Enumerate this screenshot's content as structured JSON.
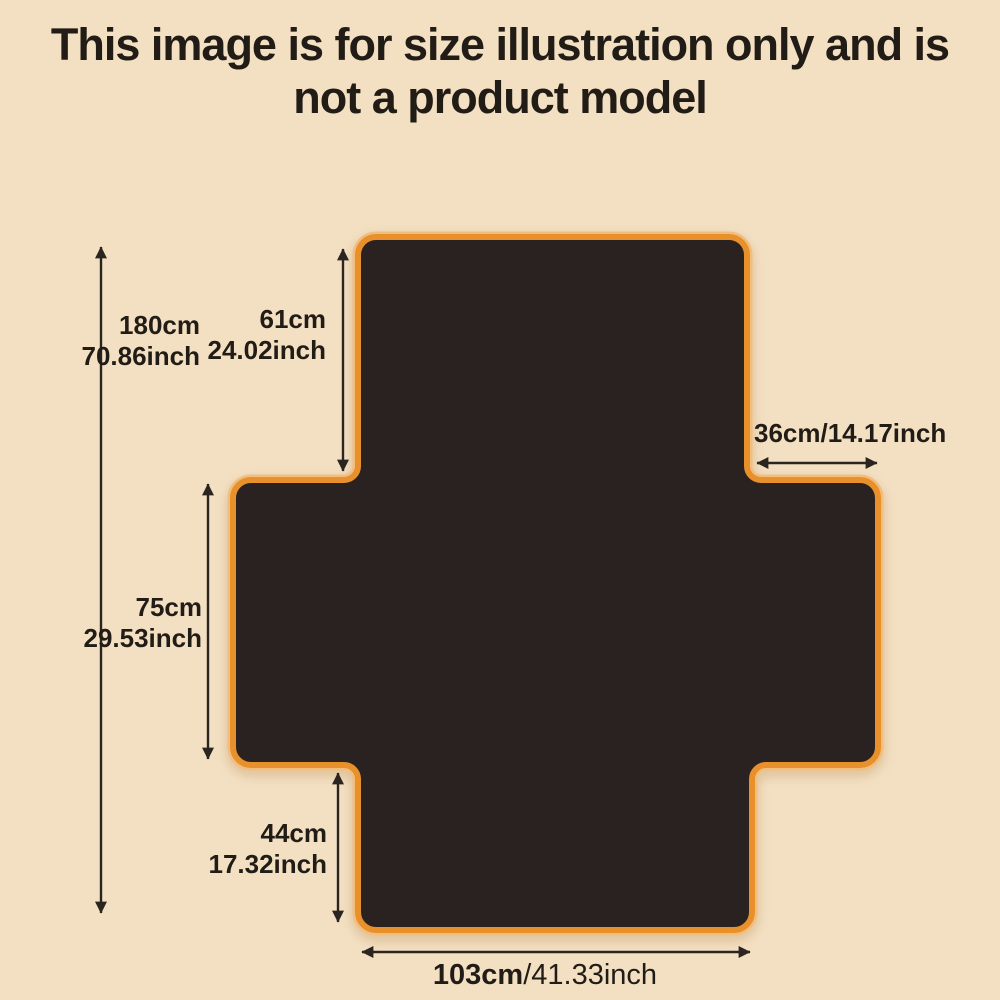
{
  "title": {
    "line1": "This image is for size illustration only and is",
    "line2": "not a product model"
  },
  "diagram": {
    "description": "Cross-shaped cover size illustration with dimension arrows",
    "colors": {
      "background": "#f3e0c3",
      "shape_fill": "#292221",
      "shape_border": "#e8912c",
      "shape_border_light": "#f2be7e",
      "arrow": "#2b2520",
      "text": "#221c16"
    },
    "dimensions": {
      "total_height": {
        "cm": "180cm",
        "inch": "70.86inch"
      },
      "back_height": {
        "cm": "61cm",
        "inch": "24.02inch"
      },
      "arm_width": {
        "cm": "36cm",
        "inch": "/14.17inch"
      },
      "seat_depth": {
        "cm": "75cm",
        "inch": "29.53inch"
      },
      "front_height": {
        "cm": "44cm",
        "inch": "17.32inch"
      },
      "bottom_width": {
        "cm": "103cm",
        "inch": "/41.33inch"
      }
    }
  }
}
